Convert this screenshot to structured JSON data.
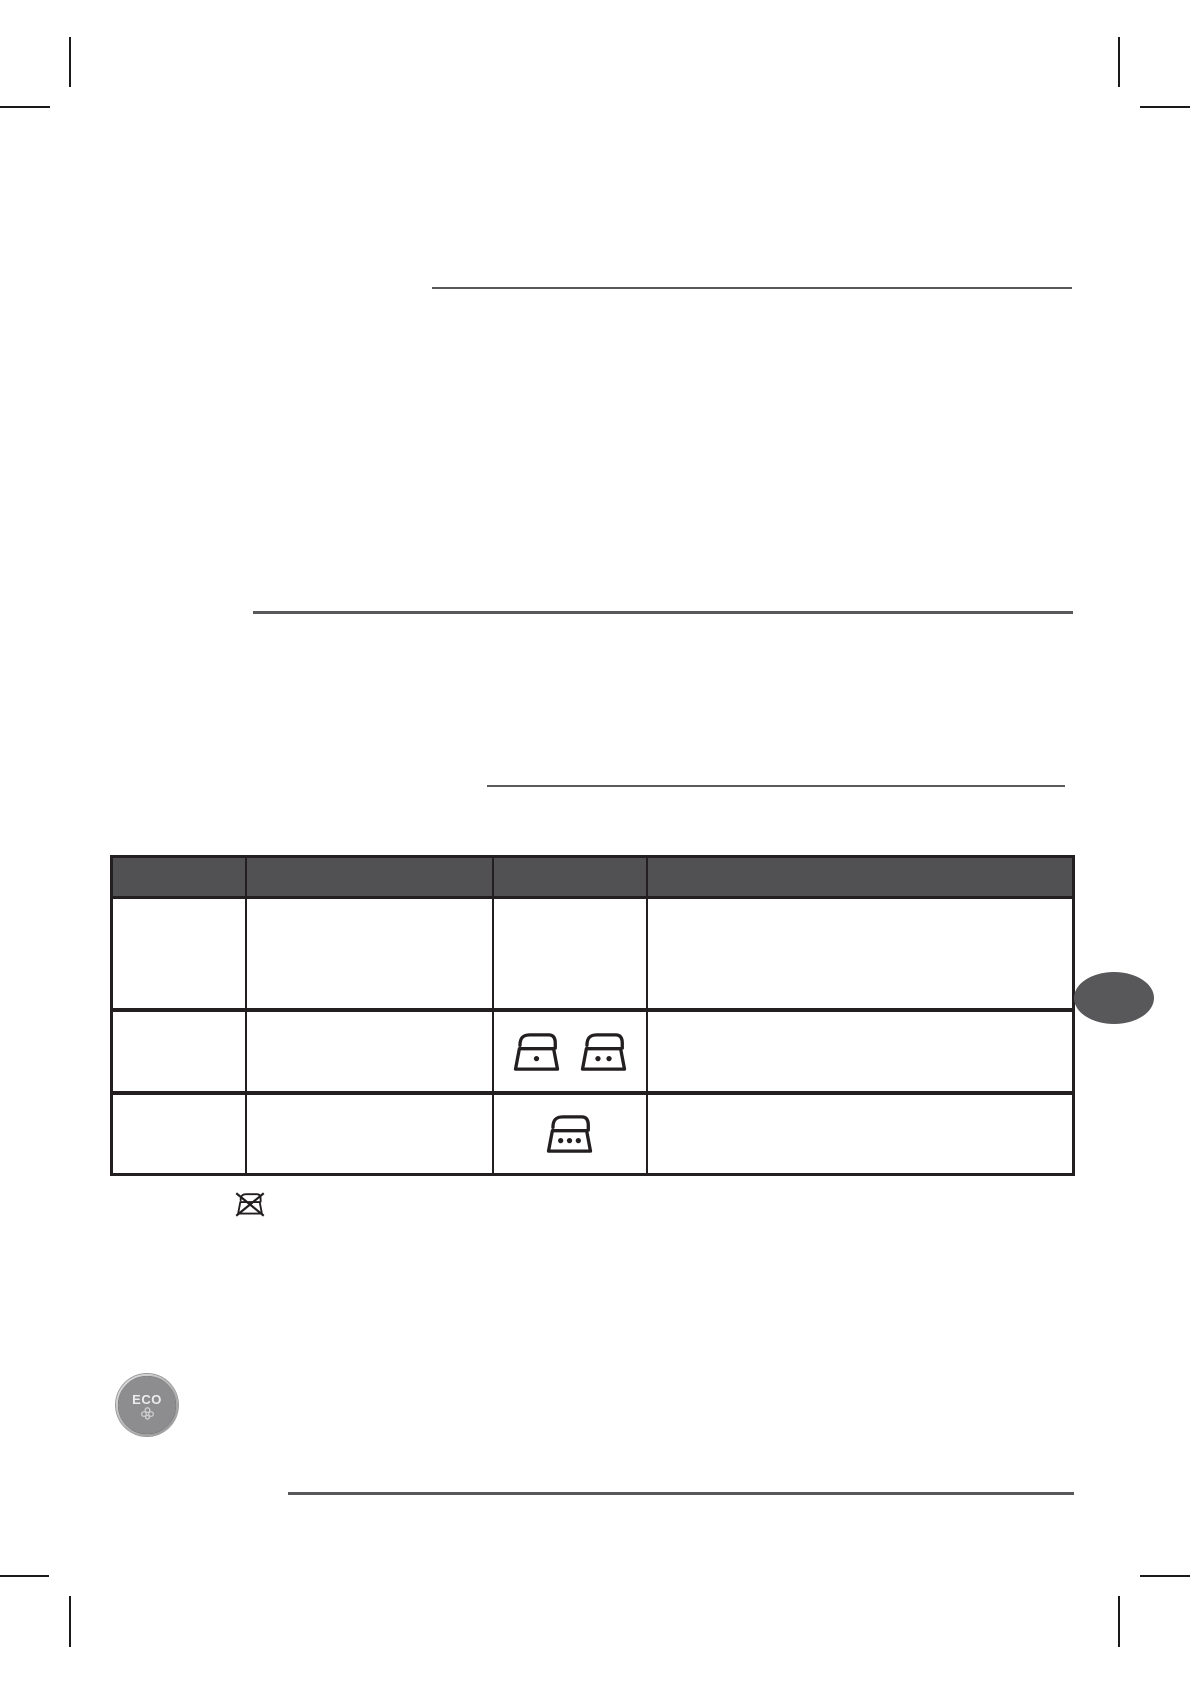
{
  "page": {
    "background": "#ffffff",
    "description": "Instruction-manual page: ironing temperature care table, ECO steam button illustration, section rules, print crop marks"
  },
  "colors": {
    "rule": "#58585a",
    "rule_thin": "#5b5b5d",
    "table_header_bg": "#515153",
    "table_border": "#231f20",
    "side_tab": "#58585a",
    "crop_mark": "#1a1a1a",
    "eco_disc": "#8d8d8f",
    "eco_label_color": "#ececee",
    "eco_glyph_color": "#cfcfd1"
  },
  "table": {
    "header_labels": [
      "",
      "",
      "",
      ""
    ],
    "rows": [
      {
        "icons": []
      },
      {
        "icons": [
          "iron-one-dot",
          "iron-two-dots"
        ]
      },
      {
        "icons": [
          "iron-three-dots"
        ]
      }
    ]
  },
  "footnote": {
    "icon": "do-not-iron"
  },
  "eco_button": {
    "label": "ECO"
  }
}
